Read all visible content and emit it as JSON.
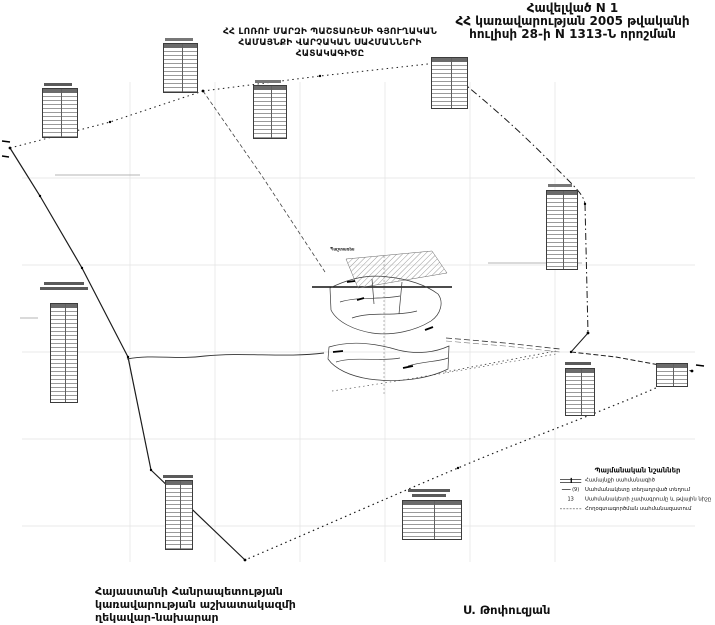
{
  "header": {
    "appendix_line1": "Հավելված N 1",
    "appendix_line2": "ՀՀ կառավարության 2005 թվականի",
    "appendix_line3": "հուլիսի 28-ի N 1313-Ն որոշման",
    "title_line1": "ՀՀ ԼՈՌՈՒ ՄԱՐԶԻ ՊԱՇՏԱՌԵՍԻ ԳՅՈՒՂԱԿԱՆ",
    "title_line2": "ՀԱՄԱՅՆՔԻ ՎԱՐՉԱԿԱՆ  ՍԱՀՄԱՆՆԵՐԻ",
    "title_line3": "ՀԱՏԱԿԱԳԻԾԸ"
  },
  "map": {
    "settlement_label": "Պաշտառես",
    "legend": {
      "title": "Պայմանական նշաններ",
      "items": [
        {
          "symbol": "",
          "label": "Համայնքի սահմանագիծ"
        },
        {
          "symbol": "(9)",
          "label": "Սահմանակետը տեղադրված տեղում"
        },
        {
          "symbol": "13",
          "label": "Սահմանակետի չափագրումը և թվային նիշը"
        },
        {
          "symbol": "",
          "label": "Հողօգտագործման սահմանազատում"
        }
      ]
    }
  },
  "footer": {
    "left_line1": "Հայաստանի Հանրապետության",
    "left_line2": "կառավարության աշխատակազմի",
    "left_line3": "ղեկավար-նախարար",
    "signature": "Ս. Թոփուզյան"
  },
  "colors": {
    "ink": "#111111",
    "paper": "#ffffff",
    "grid": "#e3e3e3"
  }
}
